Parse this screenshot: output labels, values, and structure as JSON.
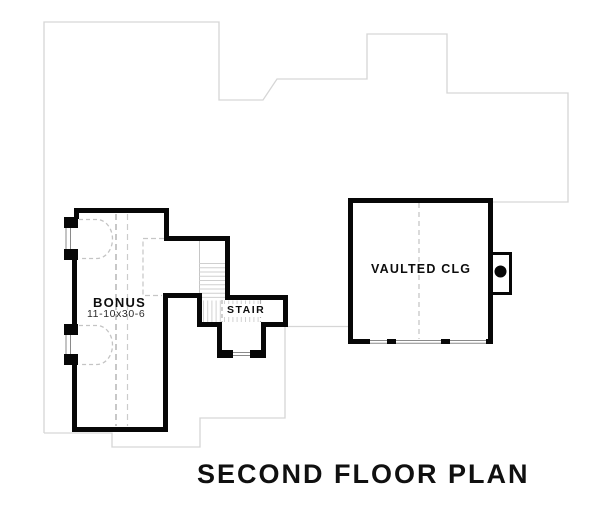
{
  "plan": {
    "title": "SECOND FLOOR PLAN",
    "rooms": [
      {
        "name": "BONUS",
        "dimensions": "11-10x30-6"
      },
      {
        "name": "STAIR"
      },
      {
        "name": "VAULTED CLG"
      }
    ],
    "colors": {
      "walls": "#070707",
      "floor_below_outline": "#d6d6d6",
      "dashed_guides": "#c4c4c4",
      "stair_treads": "#cfcfcf",
      "window_glass": "#8a8a8a"
    }
  }
}
